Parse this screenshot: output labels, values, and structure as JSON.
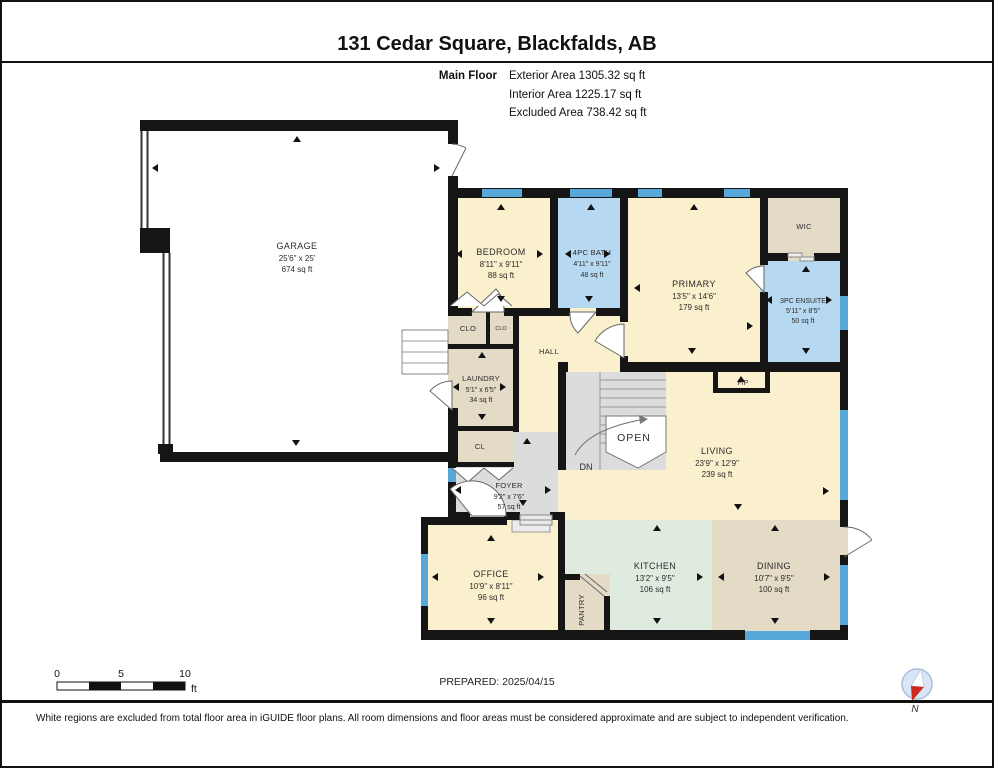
{
  "header": {
    "title": "131 Cedar Square, Blackfalds, AB",
    "floor_label": "Main Floor",
    "exterior": "Exterior Area 1305.32 sq ft",
    "interior": "Interior Area 1225.17 sq ft",
    "excluded": "Excluded Area 738.42 sq ft"
  },
  "rooms": {
    "garage": {
      "name": "GARAGE",
      "dims": "25'6\" x 25'",
      "area": "674 sq ft"
    },
    "bedroom": {
      "name": "BEDROOM",
      "dims": "8'11\" x 9'11\"",
      "area": "88 sq ft"
    },
    "bath": {
      "name": "4PC BATH",
      "dims": "4'11\" x 9'11\"",
      "area": "48 sq ft"
    },
    "primary": {
      "name": "PRIMARY",
      "dims": "13'5\" x 14'6\"",
      "area": "179 sq ft"
    },
    "wic": {
      "name": "WIC"
    },
    "ensuite": {
      "name": "3PC ENSUITE",
      "dims": "5'11\" x 8'5\"",
      "area": "50 sq ft"
    },
    "hall": {
      "name": "HALL"
    },
    "clo_a": {
      "name": "CLO"
    },
    "clo_b": {
      "name": "CLO"
    },
    "laundry": {
      "name": "LAUNDRY",
      "dims": "5'1\" x 6'5\"",
      "area": "34 sq ft"
    },
    "cl": {
      "name": "CL"
    },
    "living": {
      "name": "LIVING",
      "dims": "23'9\" x 12'9\"",
      "area": "239 sq ft"
    },
    "foyer": {
      "name": "FOYER",
      "dims": "9'2\" x 7'6\"",
      "area": "57 sq ft"
    },
    "office": {
      "name": "OFFICE",
      "dims": "10'9\" x 8'11\"",
      "area": "96 sq ft"
    },
    "pantry": {
      "name": "PANTRY"
    },
    "kitchen": {
      "name": "KITCHEN",
      "dims": "13'2\" x 9'5\"",
      "area": "106 sq ft"
    },
    "dining": {
      "name": "DINING",
      "dims": "10'7\" x 9'5\"",
      "area": "100 sq ft"
    }
  },
  "labels": {
    "fp": "F/P",
    "open": "OPEN",
    "dn": "DN"
  },
  "scalebar": {
    "t0": "0",
    "t5": "5",
    "t10": "10",
    "unit": "ft"
  },
  "footer": {
    "prepared": "PREPARED: 2025/04/15",
    "disclaimer": "White regions are excluded from total floor area in iGUIDE floor plans. All room dimensions and floor areas must be considered approximate and are subject to independent verification.",
    "compass": "N"
  },
  "colors": {
    "room_cream": "#faf0cd",
    "room_blue": "#b7d8f1",
    "room_tan": "#e3dbc5",
    "room_mint": "#e0ebe0",
    "room_gray": "#dcdcdc",
    "window_blue": "#57a7d9",
    "wall_black": "#151515",
    "compass_red": "#cc2a1e",
    "compass_fill": "#d8e6f8"
  }
}
